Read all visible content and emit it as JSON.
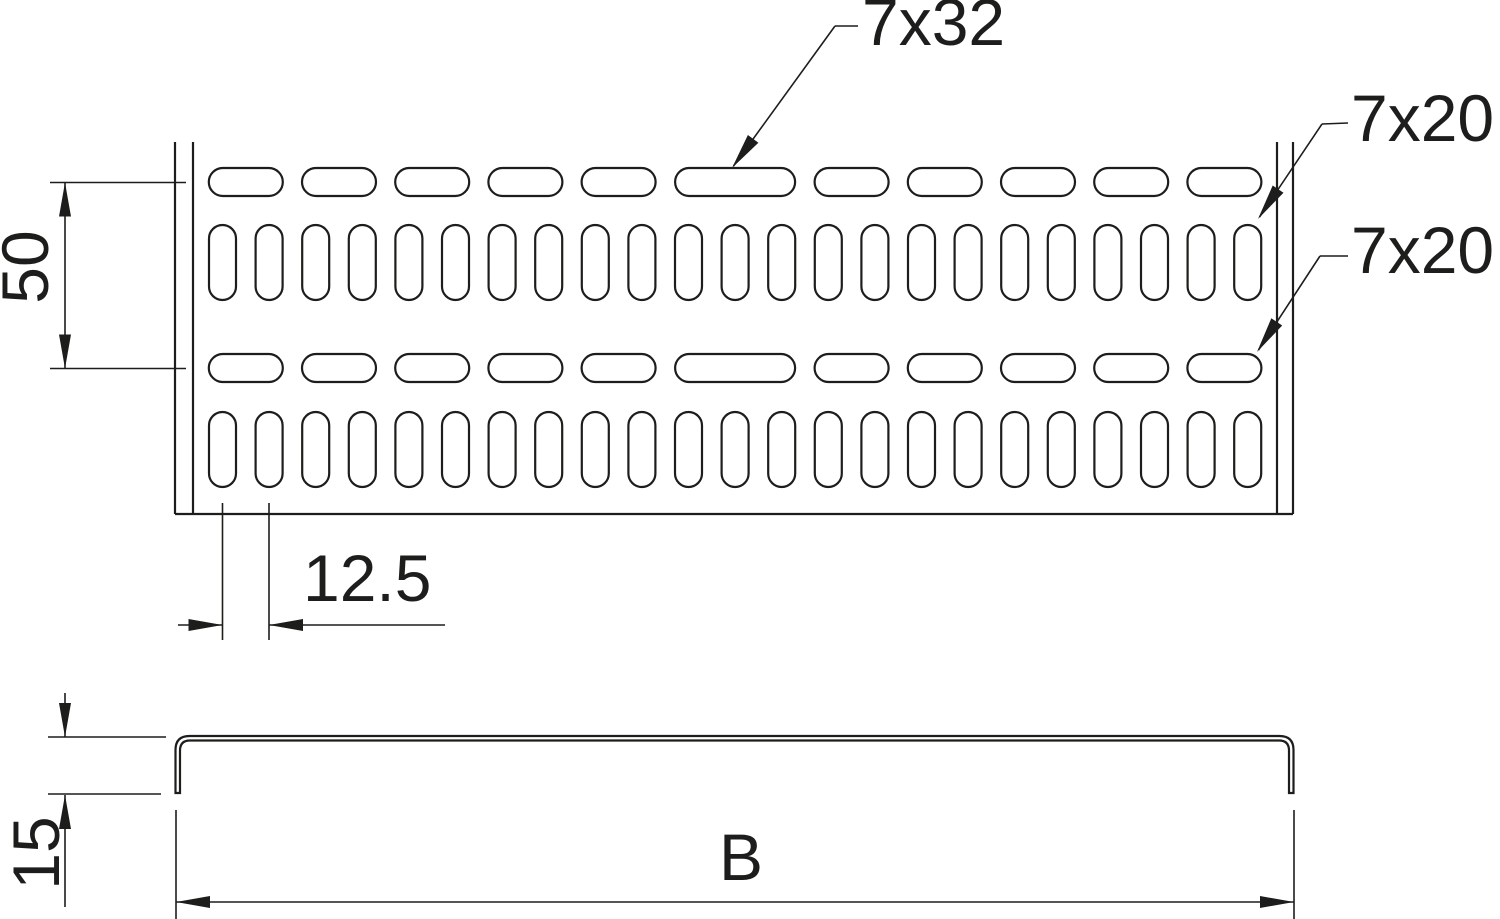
{
  "figure": {
    "background_color": "#ffffff",
    "line_color": "#1d1d1b"
  },
  "labels": {
    "slot_long": "7x32",
    "slot_vertical": "7x20",
    "slot_horizontal": "7x20",
    "row_spacing": "50",
    "slot_pitch": "12.5",
    "profile_height": "15",
    "profile_width": "B"
  }
}
